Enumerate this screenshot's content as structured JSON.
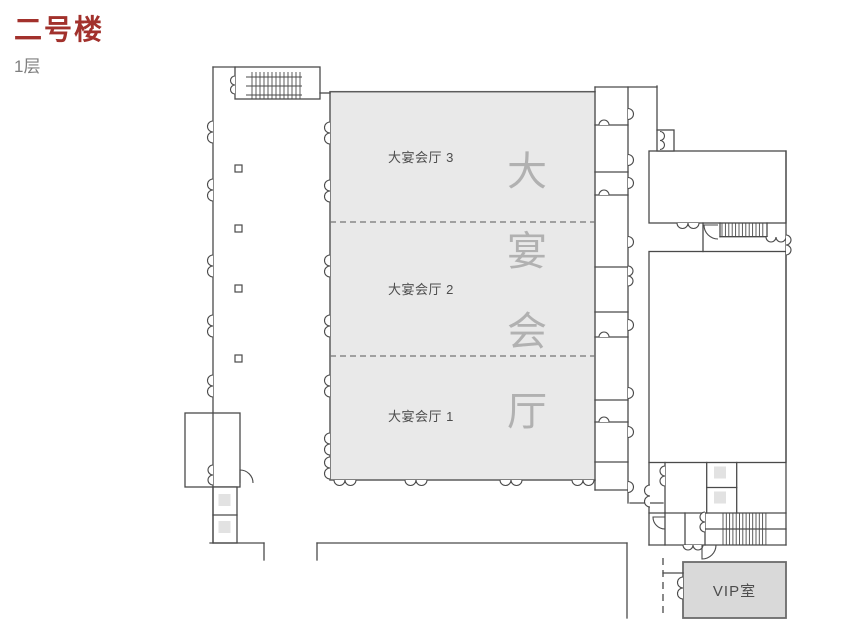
{
  "page": {
    "title": "二号楼",
    "floor": "1层"
  },
  "colors": {
    "title": "#a2312c",
    "subtitle": "#7f7f7f",
    "wall": "#4a4a4a",
    "hall_fill": "#e9e9e9",
    "vip_fill": "#d9d9d9",
    "elevator_fill": "#e2e2e2",
    "label": "#4d4d4d",
    "watermark": "#b1b1b1"
  },
  "rooms": {
    "hall_sections": [
      {
        "label": "大宴会厅 3"
      },
      {
        "label": "大宴会厅 2"
      },
      {
        "label": "大宴会厅 1"
      }
    ],
    "hall_watermark": "大宴会厅",
    "vip": {
      "label": "VIP室"
    }
  }
}
